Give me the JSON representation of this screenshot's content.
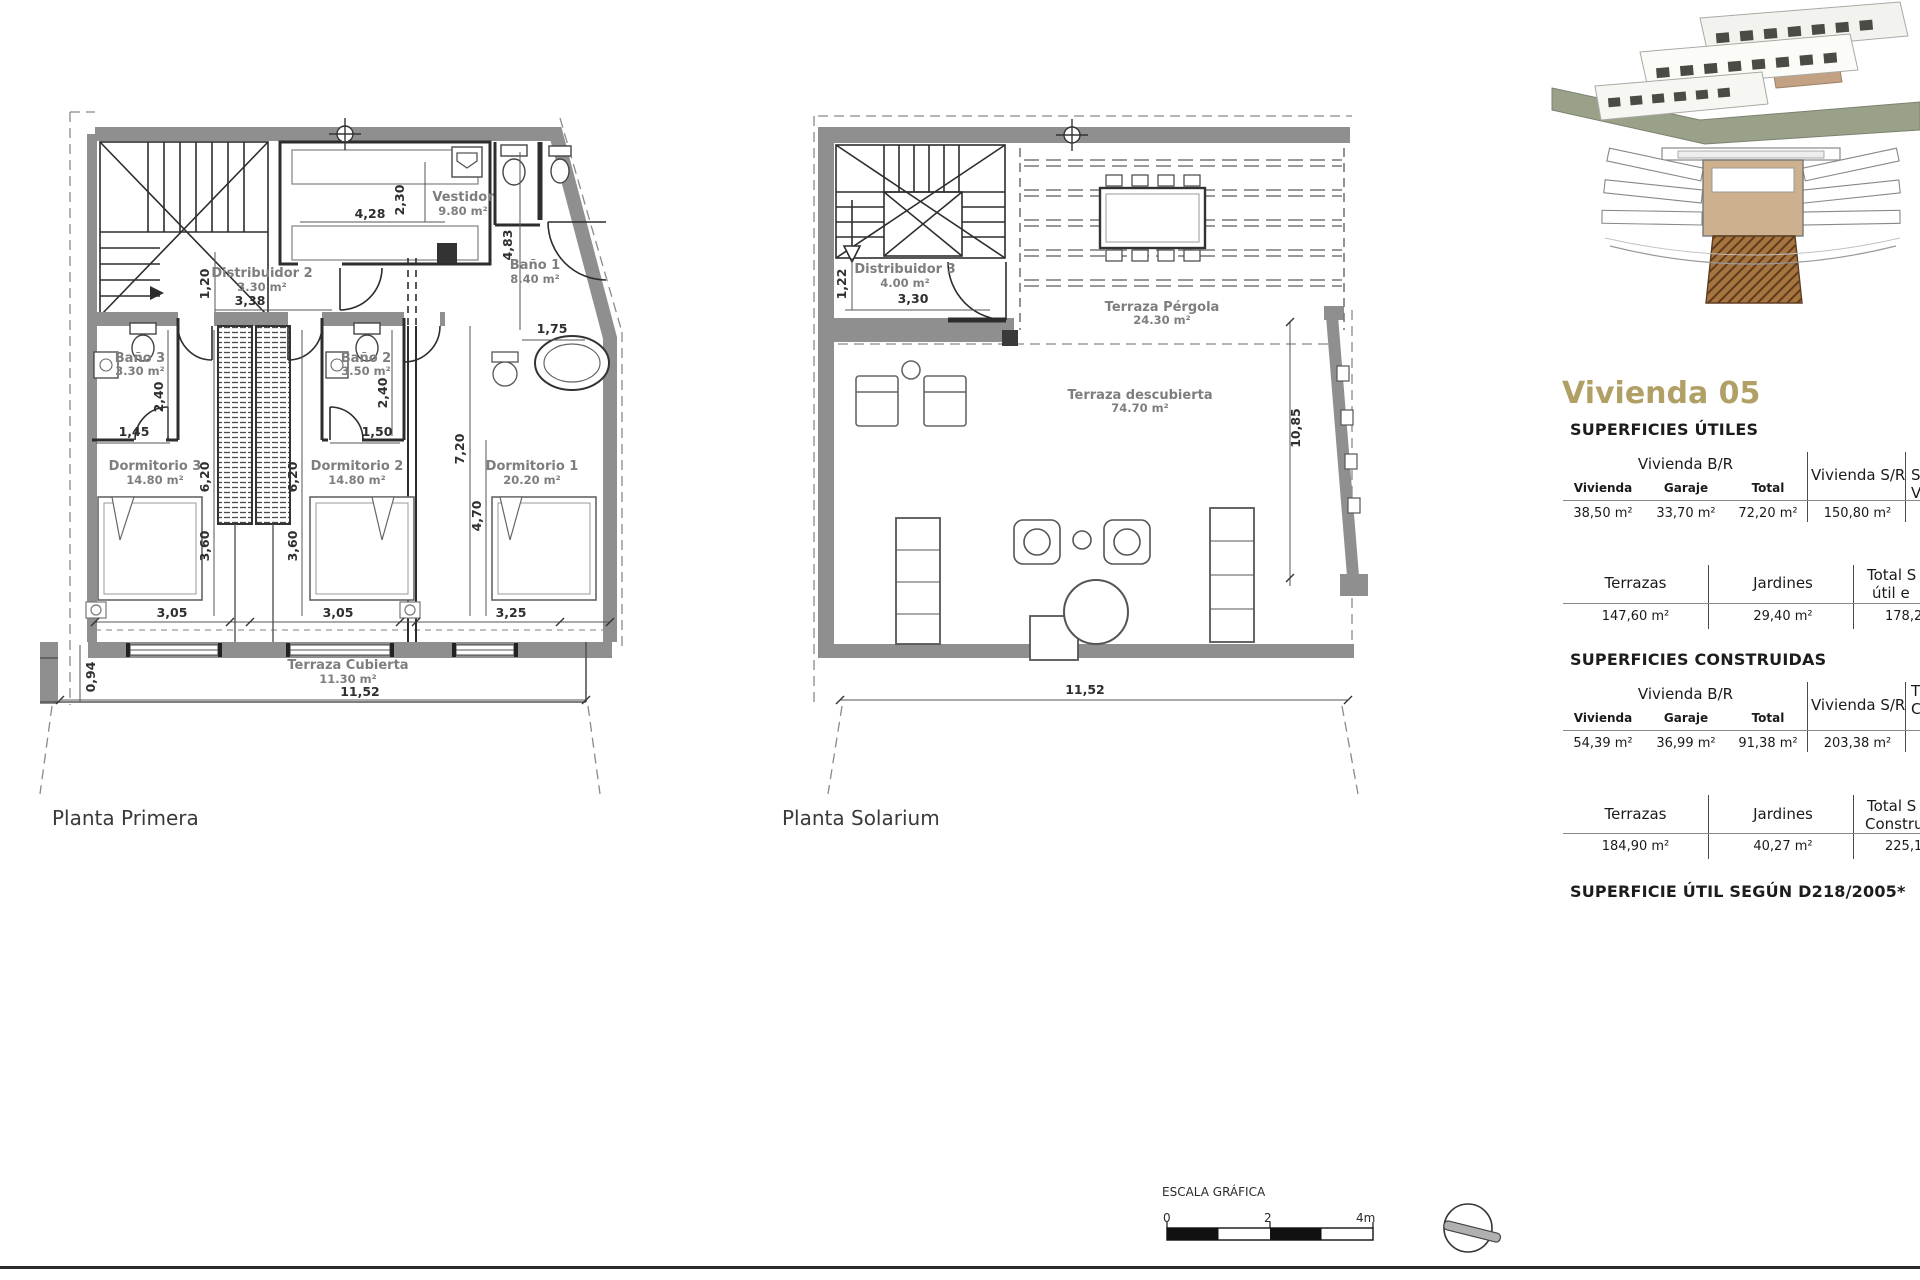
{
  "page": {
    "plan1_title": "Planta Primera",
    "plan2_title": "Planta Solarium",
    "scale_label": "ESCALA GRÁFICA",
    "scale_ticks": [
      "0",
      "2",
      "4m"
    ]
  },
  "plan1": {
    "rooms": {
      "distribuidor2": {
        "name": "Distribuidor 2",
        "area": "3.30 m²"
      },
      "vestidor": {
        "name": "Vestidor",
        "area": "9.80 m²"
      },
      "bano1": {
        "name": "Baño 1",
        "area": "8.40 m²"
      },
      "bano3": {
        "name": "Baño 3",
        "area": "3.30 m²"
      },
      "bano2": {
        "name": "Baño 2",
        "area": "3.50 m²"
      },
      "dormitorio3": {
        "name": "Dormitorio 3",
        "area": "14.80 m²"
      },
      "dormitorio2": {
        "name": "Dormitorio 2",
        "area": "14.80 m²"
      },
      "dormitorio1": {
        "name": "Dormitorio 1",
        "area": "20.20 m²"
      },
      "terraza": {
        "name": "Terraza Cubierta",
        "area": "11.30 m²"
      }
    },
    "dims": {
      "vestidor_w": "4,28",
      "vestidor_h": "2,30",
      "bano1_h": "4,83",
      "bano1_w": "1,75",
      "distr_h": "1,20",
      "distr_w": "3,38",
      "bano3_h": "2,40",
      "bano3_w": "1,45",
      "bano2_h": "2,40",
      "bano2_w": "1,50",
      "dorm3_h": "6,20",
      "dorm2_h": "6,20",
      "dorm1_h": "7,20",
      "dorm1_h2": "4,70",
      "dorm3_h2": "3,60",
      "dorm2_h2": "3,60",
      "dorm3_w": "3,05",
      "dorm2_w": "3,05",
      "dorm1_w": "3,25",
      "terraza_w": "11,52",
      "terraza_h": "0,94"
    }
  },
  "plan2": {
    "rooms": {
      "distribuidor3": {
        "name": "Distribuidor 3",
        "area": "4.00 m²"
      },
      "pergola": {
        "name": "Terraza Pérgola",
        "area": "24.30 m²"
      },
      "descubierta": {
        "name": "Terraza descubierta",
        "area": "74.70 m²"
      }
    },
    "dims": {
      "distr_h": "1,22",
      "distr_w": "3,30",
      "right_h": "10,85",
      "bottom_w": "11,52"
    }
  },
  "panel": {
    "title": "Vivienda 05",
    "utiles": {
      "heading": "SUPERFICIES ÚTILES",
      "group_header": "Vivienda B/R",
      "sr_header": "Vivienda S/R",
      "cut_header_l1": "S",
      "cut_header_l2": "V",
      "cols": [
        "Vivienda",
        "Garaje",
        "Total"
      ],
      "values": [
        "38,50 m²",
        "33,70 m²",
        "72,20 m²"
      ],
      "sr_value": "150,80 m²",
      "row2_cols": [
        "Terrazas",
        "Jardines"
      ],
      "row2_cut_l1": "Total S",
      "row2_cut_l2": "útil e",
      "row2_values": [
        "147,60 m²",
        "29,40 m²"
      ],
      "row2_cut_value": "178,2"
    },
    "construidas": {
      "heading": "SUPERFICIES CONSTRUIDAS",
      "group_header": "Vivienda B/R",
      "sr_header": "Vivienda S/R",
      "cut_header_l1": "T",
      "cut_header_l2": "C",
      "cols": [
        "Vivienda",
        "Garaje",
        "Total"
      ],
      "values": [
        "54,39 m²",
        "36,99 m²",
        "91,38 m²"
      ],
      "sr_value": "203,38 m²",
      "row2_cols": [
        "Terrazas",
        "Jardines"
      ],
      "row2_cut_l1": "Total S",
      "row2_cut_l2": "Construid",
      "row2_values": [
        "184,90 m²",
        "40,27 m²"
      ],
      "row2_cut_value": "225,1"
    },
    "footnote": "SUPERFICIE ÚTIL SEGÚN D218/2005*"
  },
  "colors": {
    "accent_tan": "#b1a066",
    "wall_gray": "#8f8f8f",
    "label_gray": "#7e7e7e",
    "hatch_brown": "#a5743f",
    "line_dark": "#2f2f2f"
  }
}
